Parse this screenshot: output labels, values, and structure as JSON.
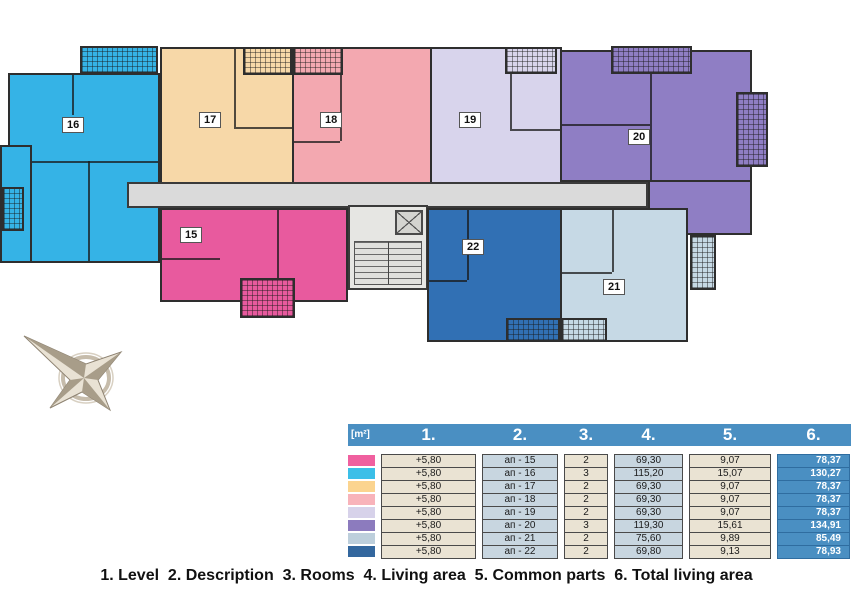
{
  "floor_plan": {
    "apartments": [
      {
        "number": "15",
        "color": "#E85A9E"
      },
      {
        "number": "16",
        "color": "#35B3E6"
      },
      {
        "number": "17",
        "color": "#F7D8A8"
      },
      {
        "number": "18",
        "color": "#F3A8B0"
      },
      {
        "number": "19",
        "color": "#D8D4EC"
      },
      {
        "number": "20",
        "color": "#8F7EC4"
      },
      {
        "number": "21",
        "color": "#C6D9E5"
      },
      {
        "number": "22",
        "color": "#3170B4"
      }
    ],
    "corridor_color": "#DADADA",
    "compass_icon": "compass-rose"
  },
  "table": {
    "unit_label": "[m²]",
    "column_headers": [
      "1.",
      "2.",
      "3.",
      "4.",
      "5.",
      "6."
    ],
    "header_color": "#4A8FC2",
    "cell_color_beige": "#EAE3D3",
    "cell_color_blue": "#C8D6E0",
    "rows": [
      {
        "color": "#F0609F",
        "level": "+5,80",
        "description": "ап - 15",
        "rooms": "2",
        "living_area": "69,30",
        "common_parts": "9,07",
        "total_living_area": "78,37"
      },
      {
        "color": "#3BBFE8",
        "level": "+5,80",
        "description": "ап - 16",
        "rooms": "3",
        "living_area": "115,20",
        "common_parts": "15,07",
        "total_living_area": "130,27"
      },
      {
        "color": "#FBD48F",
        "level": "+5,80",
        "description": "ап - 17",
        "rooms": "2",
        "living_area": "69,30",
        "common_parts": "9,07",
        "total_living_area": "78,37"
      },
      {
        "color": "#F8B3BA",
        "level": "+5,80",
        "description": "ап - 18",
        "rooms": "2",
        "living_area": "69,30",
        "common_parts": "9,07",
        "total_living_area": "78,37"
      },
      {
        "color": "#D7D2EA",
        "level": "+5,80",
        "description": "ап - 19",
        "rooms": "2",
        "living_area": "69,30",
        "common_parts": "9,07",
        "total_living_area": "78,37"
      },
      {
        "color": "#8C7BBE",
        "level": "+5,80",
        "description": "ап - 20",
        "rooms": "3",
        "living_area": "119,30",
        "common_parts": "15,61",
        "total_living_area": "134,91"
      },
      {
        "color": "#BDCFDC",
        "level": "+5,80",
        "description": "ап - 21",
        "rooms": "2",
        "living_area": "75,60",
        "common_parts": "9,89",
        "total_living_area": "85,49"
      },
      {
        "color": "#33679E",
        "level": "+5,80",
        "description": "ап - 22",
        "rooms": "2",
        "living_area": "69,80",
        "common_parts": "9,13",
        "total_living_area": "78,93"
      }
    ]
  },
  "legend": {
    "items": [
      "1. Level",
      "2. Description",
      "3. Rooms",
      "4. Living area",
      "5. Common parts",
      "6. Total living area"
    ]
  }
}
